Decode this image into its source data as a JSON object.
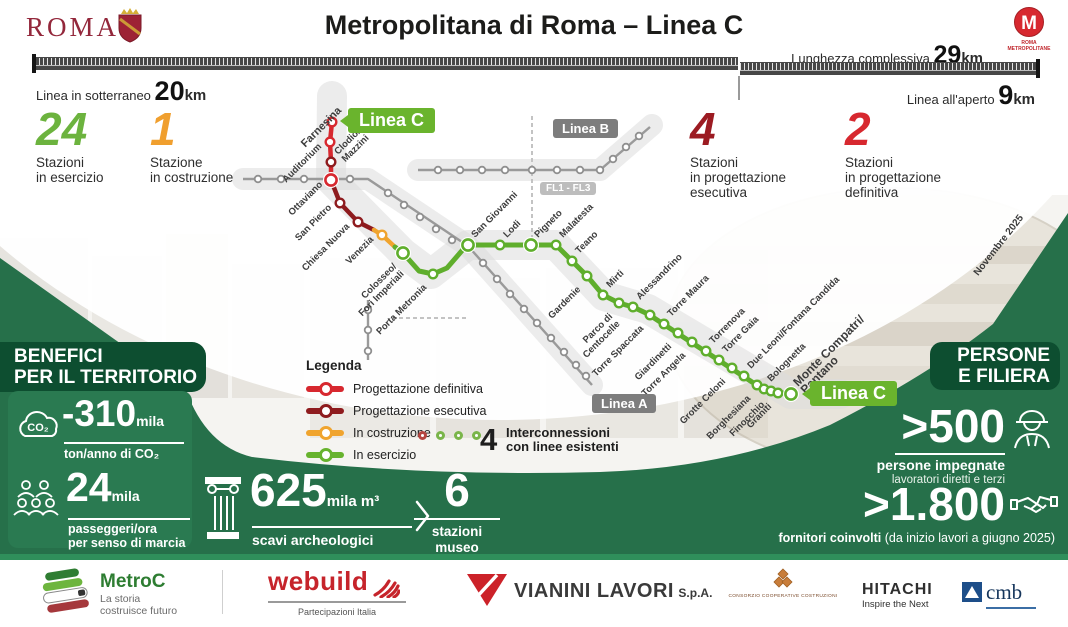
{
  "colors": {
    "accent_green": "#6cb33e",
    "accent_orange": "#f09f2e",
    "accent_red": "#d7282f",
    "accent_darkred": "#8e1b1e",
    "panel_green": "#2a7a51",
    "band_green": "#26704a",
    "header_green": "#0d4e30",
    "tag_green": "#6ab42d"
  },
  "header": {
    "city_wordmark": "ROMA",
    "title": "Metropolitana di Roma – Linea C",
    "metro_logo_letter": "M",
    "metro_logo_caption": "ROMA\nMETROPOLITANE"
  },
  "length_bar": {
    "total_label": "Lunghezza complessiva",
    "total_value": "29",
    "total_unit": "km",
    "underground_label": "Linea in sotterraneo",
    "underground_value": "20",
    "underground_unit": "km",
    "open_air_label": "Linea all'aperto",
    "open_air_value": "9",
    "open_air_unit": "km"
  },
  "stats": [
    {
      "value": "24",
      "label": "Stazioni\nin esercizio"
    },
    {
      "value": "1",
      "label": "Stazione\nin costruzione"
    },
    {
      "value": "4",
      "label": "Stazioni\nin progettazione\nesecutiva"
    },
    {
      "value": "2",
      "label": "Stazioni\nin progettazione\ndefinitiva"
    }
  ],
  "legend": {
    "title": "Legenda",
    "items": [
      {
        "label": "Progettazione definitiva",
        "color": "#d7282f"
      },
      {
        "label": "Progettazione esecutiva",
        "color": "#8e1b1e"
      },
      {
        "label": "In costruzione",
        "color": "#f0a42e"
      },
      {
        "label": "In esercizio",
        "color": "#67b32e"
      }
    ],
    "interconnections": {
      "count": "4",
      "text": "Interconnessioni\ncon linee esistenti",
      "circle_colors": [
        "#b5443f",
        "#7ab54a",
        "#7ab54a",
        "#7ab54a"
      ]
    }
  },
  "map": {
    "colors": {
      "red": "#d7282f",
      "dred": "#8e1b1e",
      "orange": "#f0a42e",
      "green": "#5fae2c"
    },
    "labels": {
      "linea_c": "Linea C",
      "linea_a": "Linea A",
      "linea_b": "Linea B",
      "fl": "FL1 - FL3"
    },
    "bands": [
      {
        "w": 30,
        "pts": [
          [
            332,
            96
          ],
          [
            331,
            180
          ],
          [
            403,
            253
          ],
          [
            431,
            274
          ],
          [
            468,
            245
          ],
          [
            556,
            245
          ],
          [
            604,
            296
          ],
          [
            648,
            309
          ],
          [
            791,
            394
          ],
          [
            840,
            394
          ]
        ]
      },
      {
        "w": 22,
        "pts": [
          [
            243,
            179
          ],
          [
            368,
            179
          ],
          [
            468,
            246
          ],
          [
            592,
            385
          ]
        ]
      },
      {
        "w": 22,
        "pts": [
          [
            418,
            170
          ],
          [
            600,
            170
          ],
          [
            652,
            125
          ]
        ]
      }
    ],
    "dashed": [
      [
        [
          532,
          116
        ],
        [
          532,
          240
        ]
      ],
      [
        [
          392,
          318
        ],
        [
          466,
          318
        ]
      ]
    ],
    "gray_lines": [
      {
        "pts": [
          [
            243,
            179
          ],
          [
            368,
            179
          ],
          [
            468,
            246
          ],
          [
            592,
            385
          ]
        ],
        "stops": [
          [
            258,
            179
          ],
          [
            281,
            179
          ],
          [
            304,
            179
          ],
          [
            350,
            179
          ],
          [
            388,
            193
          ],
          [
            404,
            205
          ],
          [
            420,
            217
          ],
          [
            436,
            229
          ],
          [
            452,
            240
          ],
          [
            483,
            263
          ],
          [
            497,
            279
          ],
          [
            510,
            294
          ],
          [
            524,
            309
          ],
          [
            537,
            323
          ],
          [
            551,
            338
          ],
          [
            564,
            352
          ],
          [
            576,
            365
          ],
          [
            586,
            376
          ]
        ]
      },
      {
        "pts": [
          [
            418,
            170
          ],
          [
            600,
            170
          ],
          [
            650,
            127
          ]
        ],
        "stops": [
          [
            438,
            170
          ],
          [
            460,
            170
          ],
          [
            482,
            170
          ],
          [
            505,
            170
          ],
          [
            532,
            170
          ],
          [
            557,
            170
          ],
          [
            580,
            170
          ],
          [
            600,
            170
          ],
          [
            613,
            159
          ],
          [
            626,
            147
          ],
          [
            639,
            136
          ]
        ]
      },
      {
        "pts": [
          [
            368,
            300
          ],
          [
            368,
            360
          ]
        ],
        "stops": [
          [
            368,
            310
          ],
          [
            368,
            330
          ],
          [
            368,
            351
          ]
        ]
      }
    ],
    "segments": [
      {
        "c": "red",
        "pts": [
          [
            332,
            122
          ],
          [
            330,
            142
          ],
          [
            331,
            162
          ],
          [
            331,
            180
          ]
        ]
      },
      {
        "c": "dred",
        "pts": [
          [
            331,
            180
          ],
          [
            340,
            203
          ],
          [
            358,
            222
          ],
          [
            374,
            230
          ]
        ]
      },
      {
        "c": "orange",
        "pts": [
          [
            374,
            230
          ],
          [
            382,
            235
          ],
          [
            395,
            247
          ]
        ]
      },
      {
        "c": "green",
        "pts": [
          [
            395,
            247
          ],
          [
            403,
            253
          ],
          [
            419,
            271
          ],
          [
            433,
            274
          ],
          [
            447,
            268
          ],
          [
            466,
            246
          ],
          [
            468,
            245
          ],
          [
            556,
            245
          ],
          [
            572,
            261
          ],
          [
            587,
            276
          ],
          [
            603,
            295
          ],
          [
            619,
            303
          ],
          [
            633,
            307
          ],
          [
            648,
            314
          ],
          [
            752,
            382
          ],
          [
            764,
            389
          ],
          [
            775,
            392
          ],
          [
            791,
            394
          ]
        ]
      }
    ],
    "stations": [
      {
        "n": "Farnesina",
        "x": 332,
        "y": 122,
        "m": "t",
        "c": "red",
        "bold": true,
        "fs": 11
      },
      {
        "n": "Auditorium",
        "x": 330,
        "y": 142,
        "m": "l",
        "c": "red"
      },
      {
        "n": "Clodio/\nMazzini",
        "x": 331,
        "y": 162,
        "m": "a",
        "c": "dred"
      },
      {
        "n": "Ottaviano",
        "x": 331,
        "y": 180,
        "m": "l",
        "c": "red",
        "big": true
      },
      {
        "n": "San Pietro",
        "x": 340,
        "y": 203,
        "m": "l",
        "c": "dred"
      },
      {
        "n": "Chiesa Nuova",
        "x": 358,
        "y": 222,
        "m": "l",
        "c": "dred"
      },
      {
        "n": "Venezia",
        "x": 382,
        "y": 235,
        "m": "l",
        "c": "orange"
      },
      {
        "n": "Colosseo/\nFori Imperiali",
        "x": 403,
        "y": 253,
        "m": "b",
        "c": "green",
        "big": true
      },
      {
        "n": "Porta Metronia",
        "x": 433,
        "y": 274,
        "m": "b",
        "c": "green"
      },
      {
        "n": "San Giovanni",
        "x": 468,
        "y": 245,
        "m": "a",
        "c": "green",
        "big": true
      },
      {
        "n": "Lodi",
        "x": 500,
        "y": 245,
        "m": "a",
        "c": "green"
      },
      {
        "n": "Pigneto",
        "x": 531,
        "y": 245,
        "m": "a",
        "c": "green",
        "big": true
      },
      {
        "n": "Malatesta",
        "x": 556,
        "y": 245,
        "m": "a",
        "c": "green"
      },
      {
        "n": "Teano",
        "x": 572,
        "y": 261,
        "m": "a",
        "c": "green"
      },
      {
        "n": "Gardenie",
        "x": 587,
        "y": 276,
        "m": "b",
        "c": "green"
      },
      {
        "n": "Mirti",
        "x": 603,
        "y": 295,
        "m": "a",
        "c": "green"
      },
      {
        "n": "Parco di\nCentocelle",
        "x": 619,
        "y": 303,
        "m": "b",
        "c": "green"
      },
      {
        "n": "Alessandrino",
        "x": 633,
        "y": 307,
        "m": "a",
        "c": "green"
      },
      {
        "n": "Torre Spaccata",
        "x": 650,
        "y": 315,
        "m": "b",
        "c": "green"
      },
      {
        "n": "Torre Maura",
        "x": 664,
        "y": 324,
        "m": "a",
        "c": "green"
      },
      {
        "n": "Giardinetti",
        "x": 678,
        "y": 333,
        "m": "b",
        "c": "green"
      },
      {
        "n": "Torre Angela",
        "x": 692,
        "y": 342,
        "m": "b",
        "c": "green"
      },
      {
        "n": "Torrenova",
        "x": 706,
        "y": 351,
        "m": "a",
        "c": "green"
      },
      {
        "n": "Torre Gaia",
        "x": 719,
        "y": 360,
        "m": "a",
        "c": "green"
      },
      {
        "n": "Grotte Celoni",
        "x": 732,
        "y": 368,
        "m": "b",
        "c": "green"
      },
      {
        "n": "Due Leoni/Fontana Candida",
        "x": 744,
        "y": 376,
        "m": "a",
        "c": "green"
      },
      {
        "n": "Borghesiana",
        "x": 757,
        "y": 385,
        "m": "b",
        "c": "green"
      },
      {
        "n": "Bolognetta",
        "x": 764,
        "y": 389,
        "m": "a",
        "c": "green"
      },
      {
        "n": "Finocchio",
        "x": 771,
        "y": 391,
        "m": "b",
        "c": "green"
      },
      {
        "n": "Graniti",
        "x": 778,
        "y": 393,
        "m": "b",
        "c": "green"
      },
      {
        "n": "Monte Compatri/\nPantano",
        "x": 791,
        "y": 394,
        "m": "a",
        "c": "green",
        "big": true,
        "bold": true,
        "fs": 12
      }
    ]
  },
  "benefits": {
    "title": "BENEFICI\nPER IL TERRITORIO",
    "co2": {
      "value": "-310",
      "unit": "mila",
      "caption": "ton/anno di CO₂"
    },
    "passengers": {
      "value": "24",
      "unit": "mila",
      "caption": "passeggeri/ora\nper senso di marcia"
    }
  },
  "excavations": {
    "value": "625",
    "unit": "mila m³",
    "caption": "scavi archeologici"
  },
  "museums": {
    "value": "6",
    "caption": "stazioni museo"
  },
  "people": {
    "title": "PERSONE\nE FILIERA",
    "workers": {
      "value": ">500",
      "caption": "persone impegnate",
      "subcaption": "lavoratori diretti e terzi"
    },
    "suppliers": {
      "value": ">1.800",
      "caption_bold": "fornitori coinvolti",
      "caption_normal": " (da inizio lavori a giugno 2025)"
    }
  },
  "date_note": "Novembre 2025",
  "footer": {
    "metroc": {
      "name": "MetroC",
      "tagline": "La storia\ncostruisce futuro"
    },
    "webuild": {
      "name": "webuild",
      "sub": "Partecipazioni Italia"
    },
    "vianini": {
      "name": "VIANINI LAVORI",
      "suffix": "S.p.A."
    },
    "ccc": {
      "name": "CONSORZIO COOPERATIVE COSTRUZIONI"
    },
    "hitachi": {
      "name": "HITACHI",
      "tagline": "Inspire the Next"
    },
    "cmb": {
      "name": "cmb"
    }
  }
}
